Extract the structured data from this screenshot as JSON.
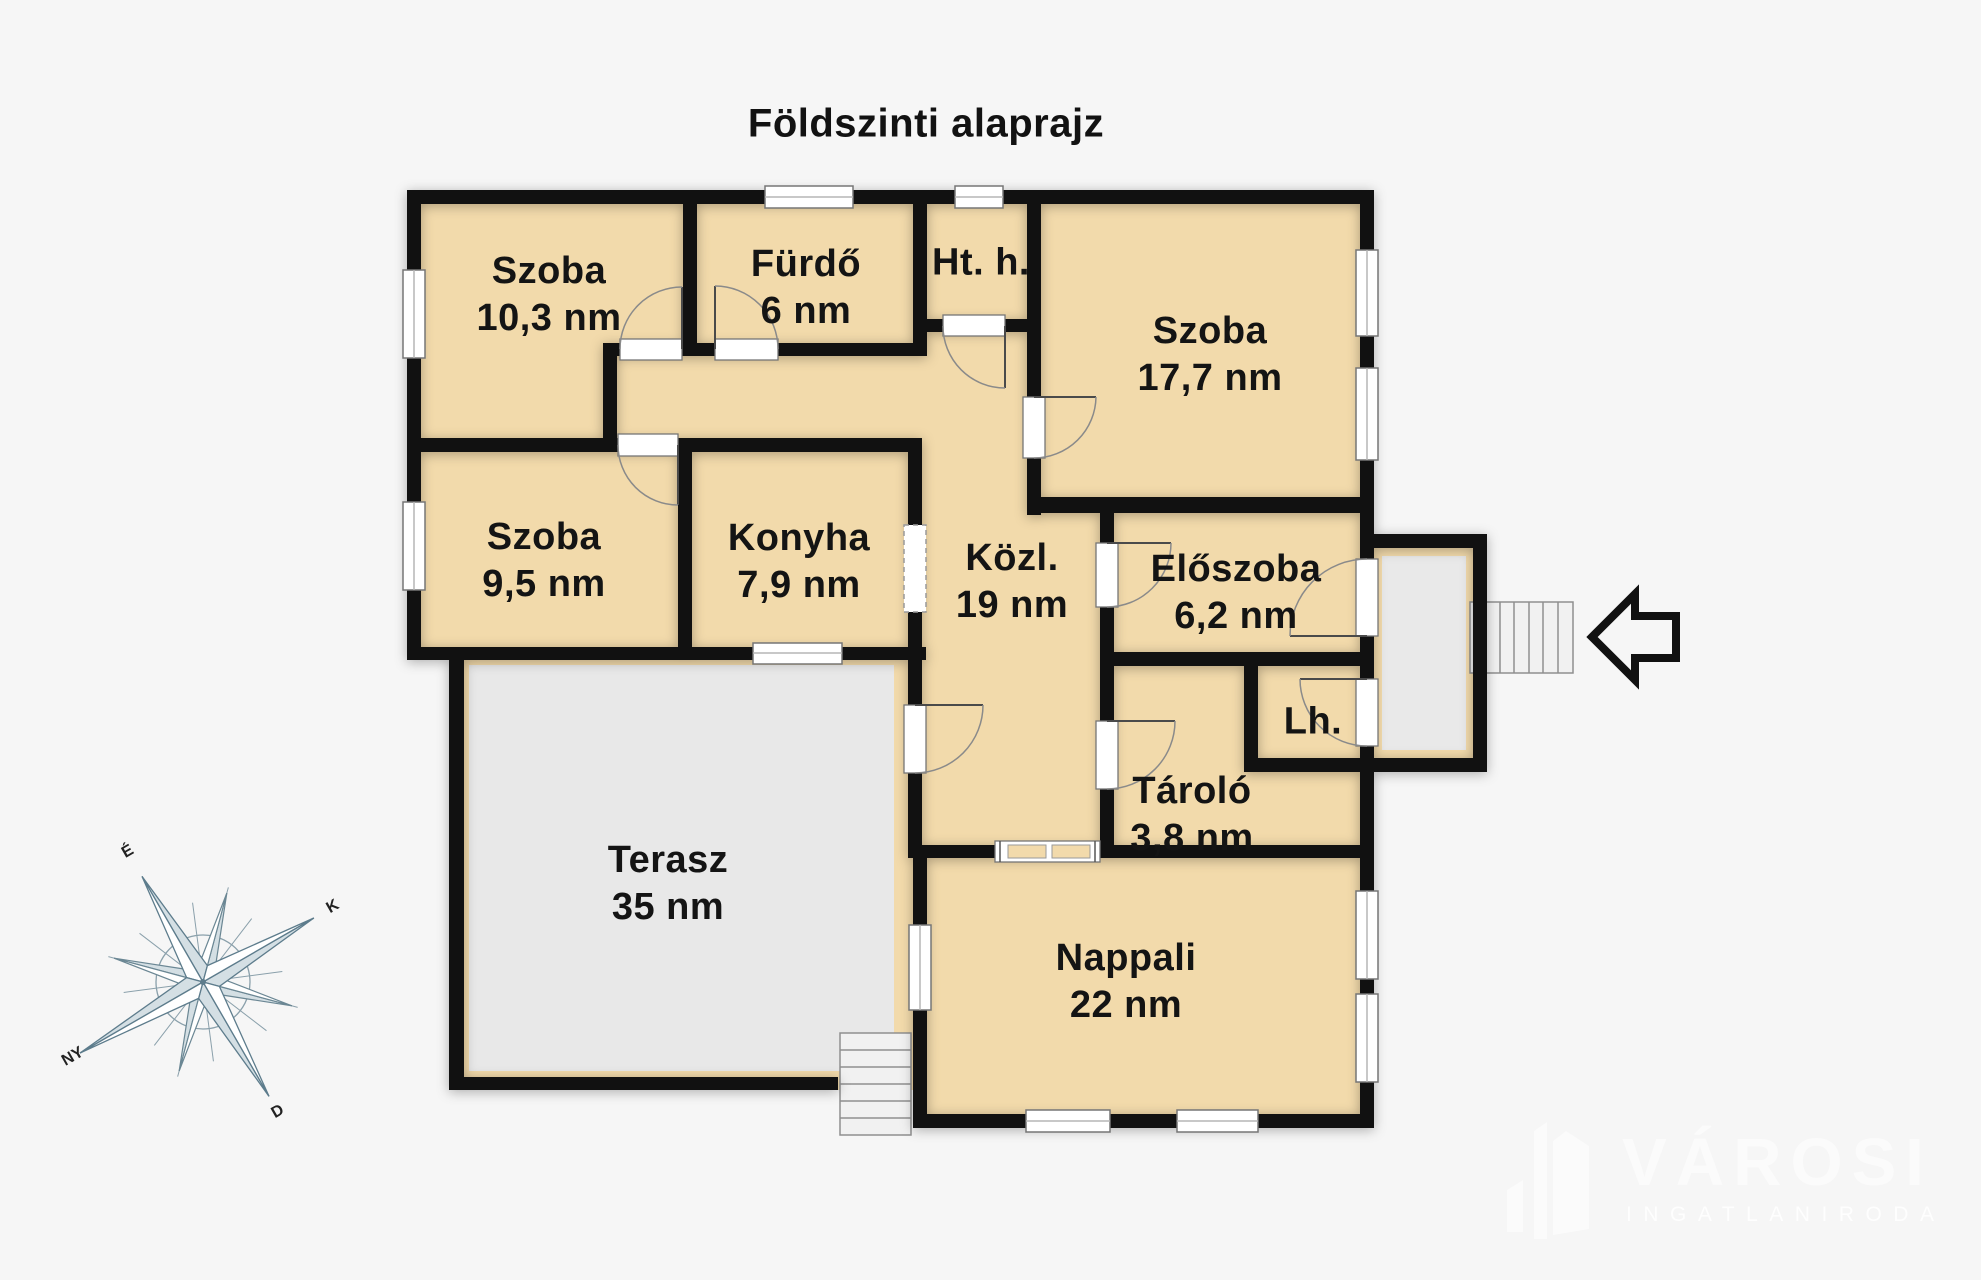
{
  "title": "Földszinti alaprajz",
  "rooms": [
    {
      "id": "szoba-1",
      "line1": "Szoba",
      "line2": "10,3 nm"
    },
    {
      "id": "furdo",
      "line1": "Fürdő",
      "line2": "6 nm"
    },
    {
      "id": "haztartasi",
      "line1": "Ht. h.",
      "line2": ""
    },
    {
      "id": "szoba-2",
      "line1": "Szoba",
      "line2": "17,7 nm"
    },
    {
      "id": "szoba-3",
      "line1": "Szoba",
      "line2": "9,5 nm"
    },
    {
      "id": "konyha",
      "line1": "Konyha",
      "line2": "7,9 nm"
    },
    {
      "id": "kozlekedo",
      "line1": "Közl.",
      "line2": "19 nm"
    },
    {
      "id": "eloszoba",
      "line1": "Előszoba",
      "line2": "6,2 nm"
    },
    {
      "id": "lepcsohaz",
      "line1": "Lh.",
      "line2": ""
    },
    {
      "id": "tarolo",
      "line1": "Tároló",
      "line2": "3,8 nm"
    },
    {
      "id": "terasz",
      "line1": "Terasz",
      "line2": "35 nm"
    },
    {
      "id": "nappali",
      "line1": "Nappali",
      "line2": "22 nm"
    }
  ],
  "compass": {
    "north": "É",
    "east": "K",
    "south": "D",
    "west": "NY"
  },
  "watermark": {
    "brand": "VÁROSI",
    "tagline": "INGATLANIRODA"
  },
  "colors": {
    "background": "#f6f6f6",
    "room_fill": "#f2daab",
    "wall": "#111111",
    "terrace_fill": "#e8e8e8",
    "stair_fill": "#f1f1f1",
    "compass_line": "#6b8794",
    "label_text": "#141414",
    "watermark_text": "#fbfbfb"
  }
}
